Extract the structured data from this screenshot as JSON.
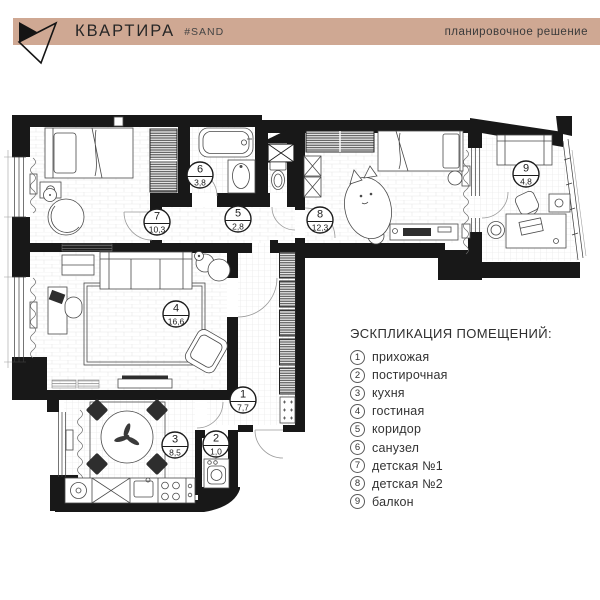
{
  "header": {
    "bar_color": "#cfa893",
    "logo_icon": "paper-plane-logo",
    "title": "КВАРТИРА",
    "hashtag": "#SAND",
    "subtitle": "планировочное решение"
  },
  "legend": {
    "title": "ЭСКПЛИКАЦИЯ ПОМЕЩЕНИЙ:",
    "items": [
      {
        "num": "1",
        "label": "прихожая"
      },
      {
        "num": "2",
        "label": "постирочная"
      },
      {
        "num": "3",
        "label": "кухня"
      },
      {
        "num": "4",
        "label": "гостиная"
      },
      {
        "num": "5",
        "label": "коридор"
      },
      {
        "num": "6",
        "label": "санузел"
      },
      {
        "num": "7",
        "label": "детская №1"
      },
      {
        "num": "8",
        "label": "детская №2"
      },
      {
        "num": "9",
        "label": "балкон"
      }
    ]
  },
  "rooms": [
    {
      "num": "1",
      "area": "7,7"
    },
    {
      "num": "2",
      "area": "1,0"
    },
    {
      "num": "3",
      "area": "8,5"
    },
    {
      "num": "4",
      "area": "16,6"
    },
    {
      "num": "5",
      "area": "2,8"
    },
    {
      "num": "6",
      "area": "3,8"
    },
    {
      "num": "7",
      "area": "10,3"
    },
    {
      "num": "8",
      "area": "12,3"
    },
    {
      "num": "9",
      "area": "4,8"
    }
  ]
}
